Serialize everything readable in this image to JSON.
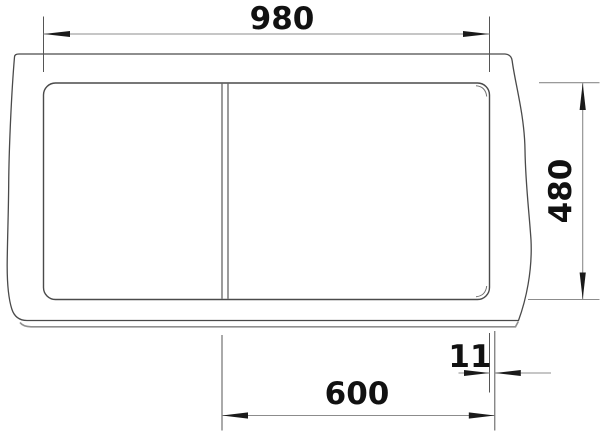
{
  "drawing": {
    "dimensions": {
      "top_width": "980",
      "right_depth": "480",
      "bottom_width": "600",
      "edge_offset": "11"
    },
    "colors": {
      "outline": "#4a4a4a",
      "dim_line": "#8c8c8c",
      "extension_line": "#555555",
      "arrow": "#1a1a1a",
      "text": "#111111",
      "background": "#ffffff",
      "secondary_edge": "#8f8f8f"
    }
  }
}
